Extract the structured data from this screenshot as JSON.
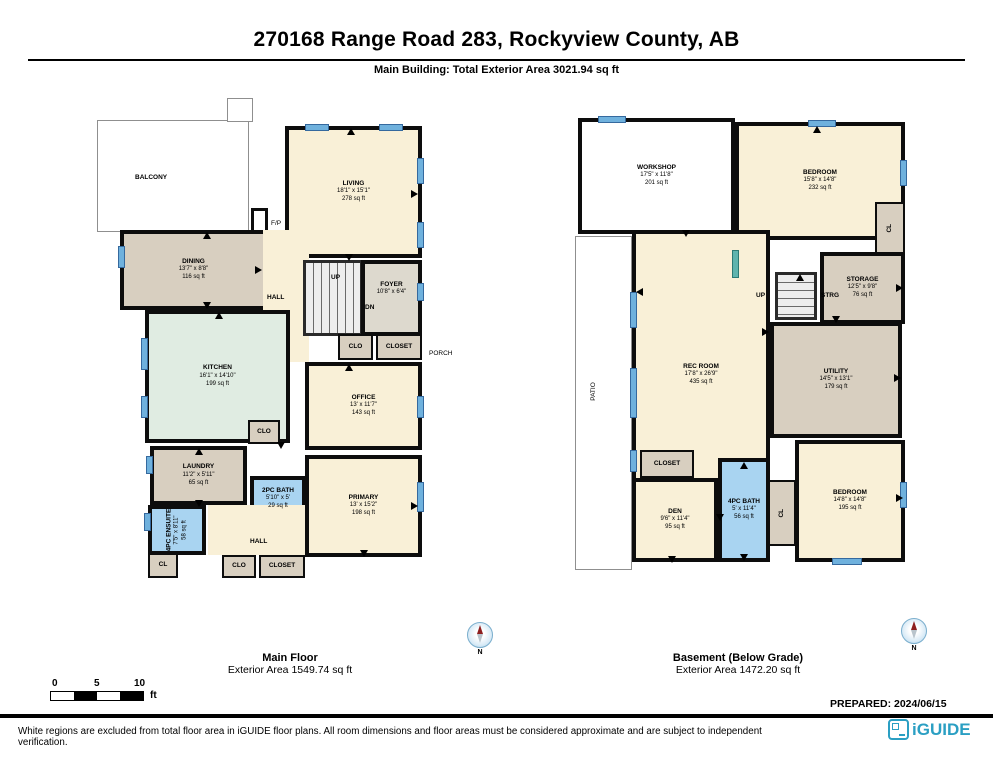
{
  "page": {
    "title": "270168 Range Road 283, Rockyview County, AB",
    "subtitle": "Main Building: Total Exterior Area 3021.94 sq ft",
    "prepared_label": "PREPARED: 2024/06/15",
    "disclaimer": "White regions are excluded from total floor area in iGUIDE floor plans. All room dimensions and floor areas must be considered approximate and are subject to independent verification.",
    "brand": "iGUIDE"
  },
  "scale_bar": {
    "ticks": [
      "0",
      "5",
      "10"
    ],
    "unit": "ft"
  },
  "compass": {
    "north_label": "N"
  },
  "colors": {
    "room_cream": "#f9f0d7",
    "room_tan": "#d8cfc0",
    "room_grey": "#ddd9ce",
    "kitchen_green": "#e0ece2",
    "bath_blue": "#a9d4f1",
    "window_blue": "#6fb1dd",
    "wall_black": "#0d0d0d",
    "brand_teal": "#2b9fc3"
  },
  "main_floor": {
    "label": "Main Floor",
    "area_label": "Exterior Area 1549.74 sq ft",
    "rooms": {
      "balcony": {
        "name": "BALCONY"
      },
      "living": {
        "name": "LIVING",
        "dims": "18'1\" x 15'1\"",
        "area": "278 sq ft"
      },
      "fp": {
        "name": "F/P"
      },
      "dining": {
        "name": "DINING",
        "dims": "13'7\" x 8'8\"",
        "area": "116 sq ft"
      },
      "kitchen": {
        "name": "KITCHEN",
        "dims": "16'1\" x 14'10\"",
        "area": "199 sq ft"
      },
      "hall": {
        "name": "HALL"
      },
      "stairs_up": {
        "name": "UP"
      },
      "stairs_dn": {
        "name": "DN"
      },
      "foyer": {
        "name": "FOYER",
        "dims": "10'8\" x 6'4\""
      },
      "clo_foyer": {
        "name": "CLO"
      },
      "closet_foyer": {
        "name": "CLOSET"
      },
      "office": {
        "name": "OFFICE",
        "dims": "13' x 11'7\"",
        "area": "143 sq ft"
      },
      "clo_hall": {
        "name": "CLO"
      },
      "laundry": {
        "name": "LAUNDRY",
        "dims": "11'2\" x 5'11\"",
        "area": "65 sq ft"
      },
      "bath2pc": {
        "name": "2PC BATH",
        "dims": "5'10\" x 5'",
        "area": "29 sq ft"
      },
      "ensuite": {
        "name": "4PC ENSUITE",
        "dims": "7'5\" x 8'11\"",
        "area": "58 sq ft"
      },
      "cl": {
        "name": "CL"
      },
      "hall2": {
        "name": "HALL"
      },
      "clo_hall2": {
        "name": "CLO"
      },
      "closet_hall2": {
        "name": "CLOSET"
      },
      "primary": {
        "name": "PRIMARY",
        "dims": "13' x 15'2\"",
        "area": "198 sq ft"
      },
      "porch": {
        "name": "PORCH"
      }
    }
  },
  "basement": {
    "label": "Basement (Below Grade)",
    "area_label": "Exterior Area 1472.20 sq ft",
    "rooms": {
      "workshop": {
        "name": "WORKSHOP",
        "dims": "17'5\" x 11'8\"",
        "area": "201 sq ft"
      },
      "bedroom1": {
        "name": "BEDROOM",
        "dims": "15'8\" x 14'8\"",
        "area": "232 sq ft"
      },
      "cl1": {
        "name": "CL"
      },
      "recroom": {
        "name": "REC ROOM",
        "dims": "17'8\" x 26'9\"",
        "area": "435 sq ft"
      },
      "stairs_up": {
        "name": "UP"
      },
      "strg": {
        "name": "STRG"
      },
      "storage": {
        "name": "STORAGE",
        "dims": "12'5\" x 9'8\"",
        "area": "76 sq ft"
      },
      "utility": {
        "name": "UTILITY",
        "dims": "14'5\" x 13'1\"",
        "area": "179 sq ft"
      },
      "closet": {
        "name": "CLOSET"
      },
      "den": {
        "name": "DEN",
        "dims": "9'6\" x 11'4\"",
        "area": "95 sq ft"
      },
      "bath4pc": {
        "name": "4PC BATH",
        "dims": "5' x 11'4\"",
        "area": "56 sq ft"
      },
      "cl2": {
        "name": "CL"
      },
      "bedroom2": {
        "name": "BEDROOM",
        "dims": "14'8\" x 14'8\"",
        "area": "195 sq ft"
      },
      "patio": {
        "name": "PATIO"
      }
    }
  }
}
